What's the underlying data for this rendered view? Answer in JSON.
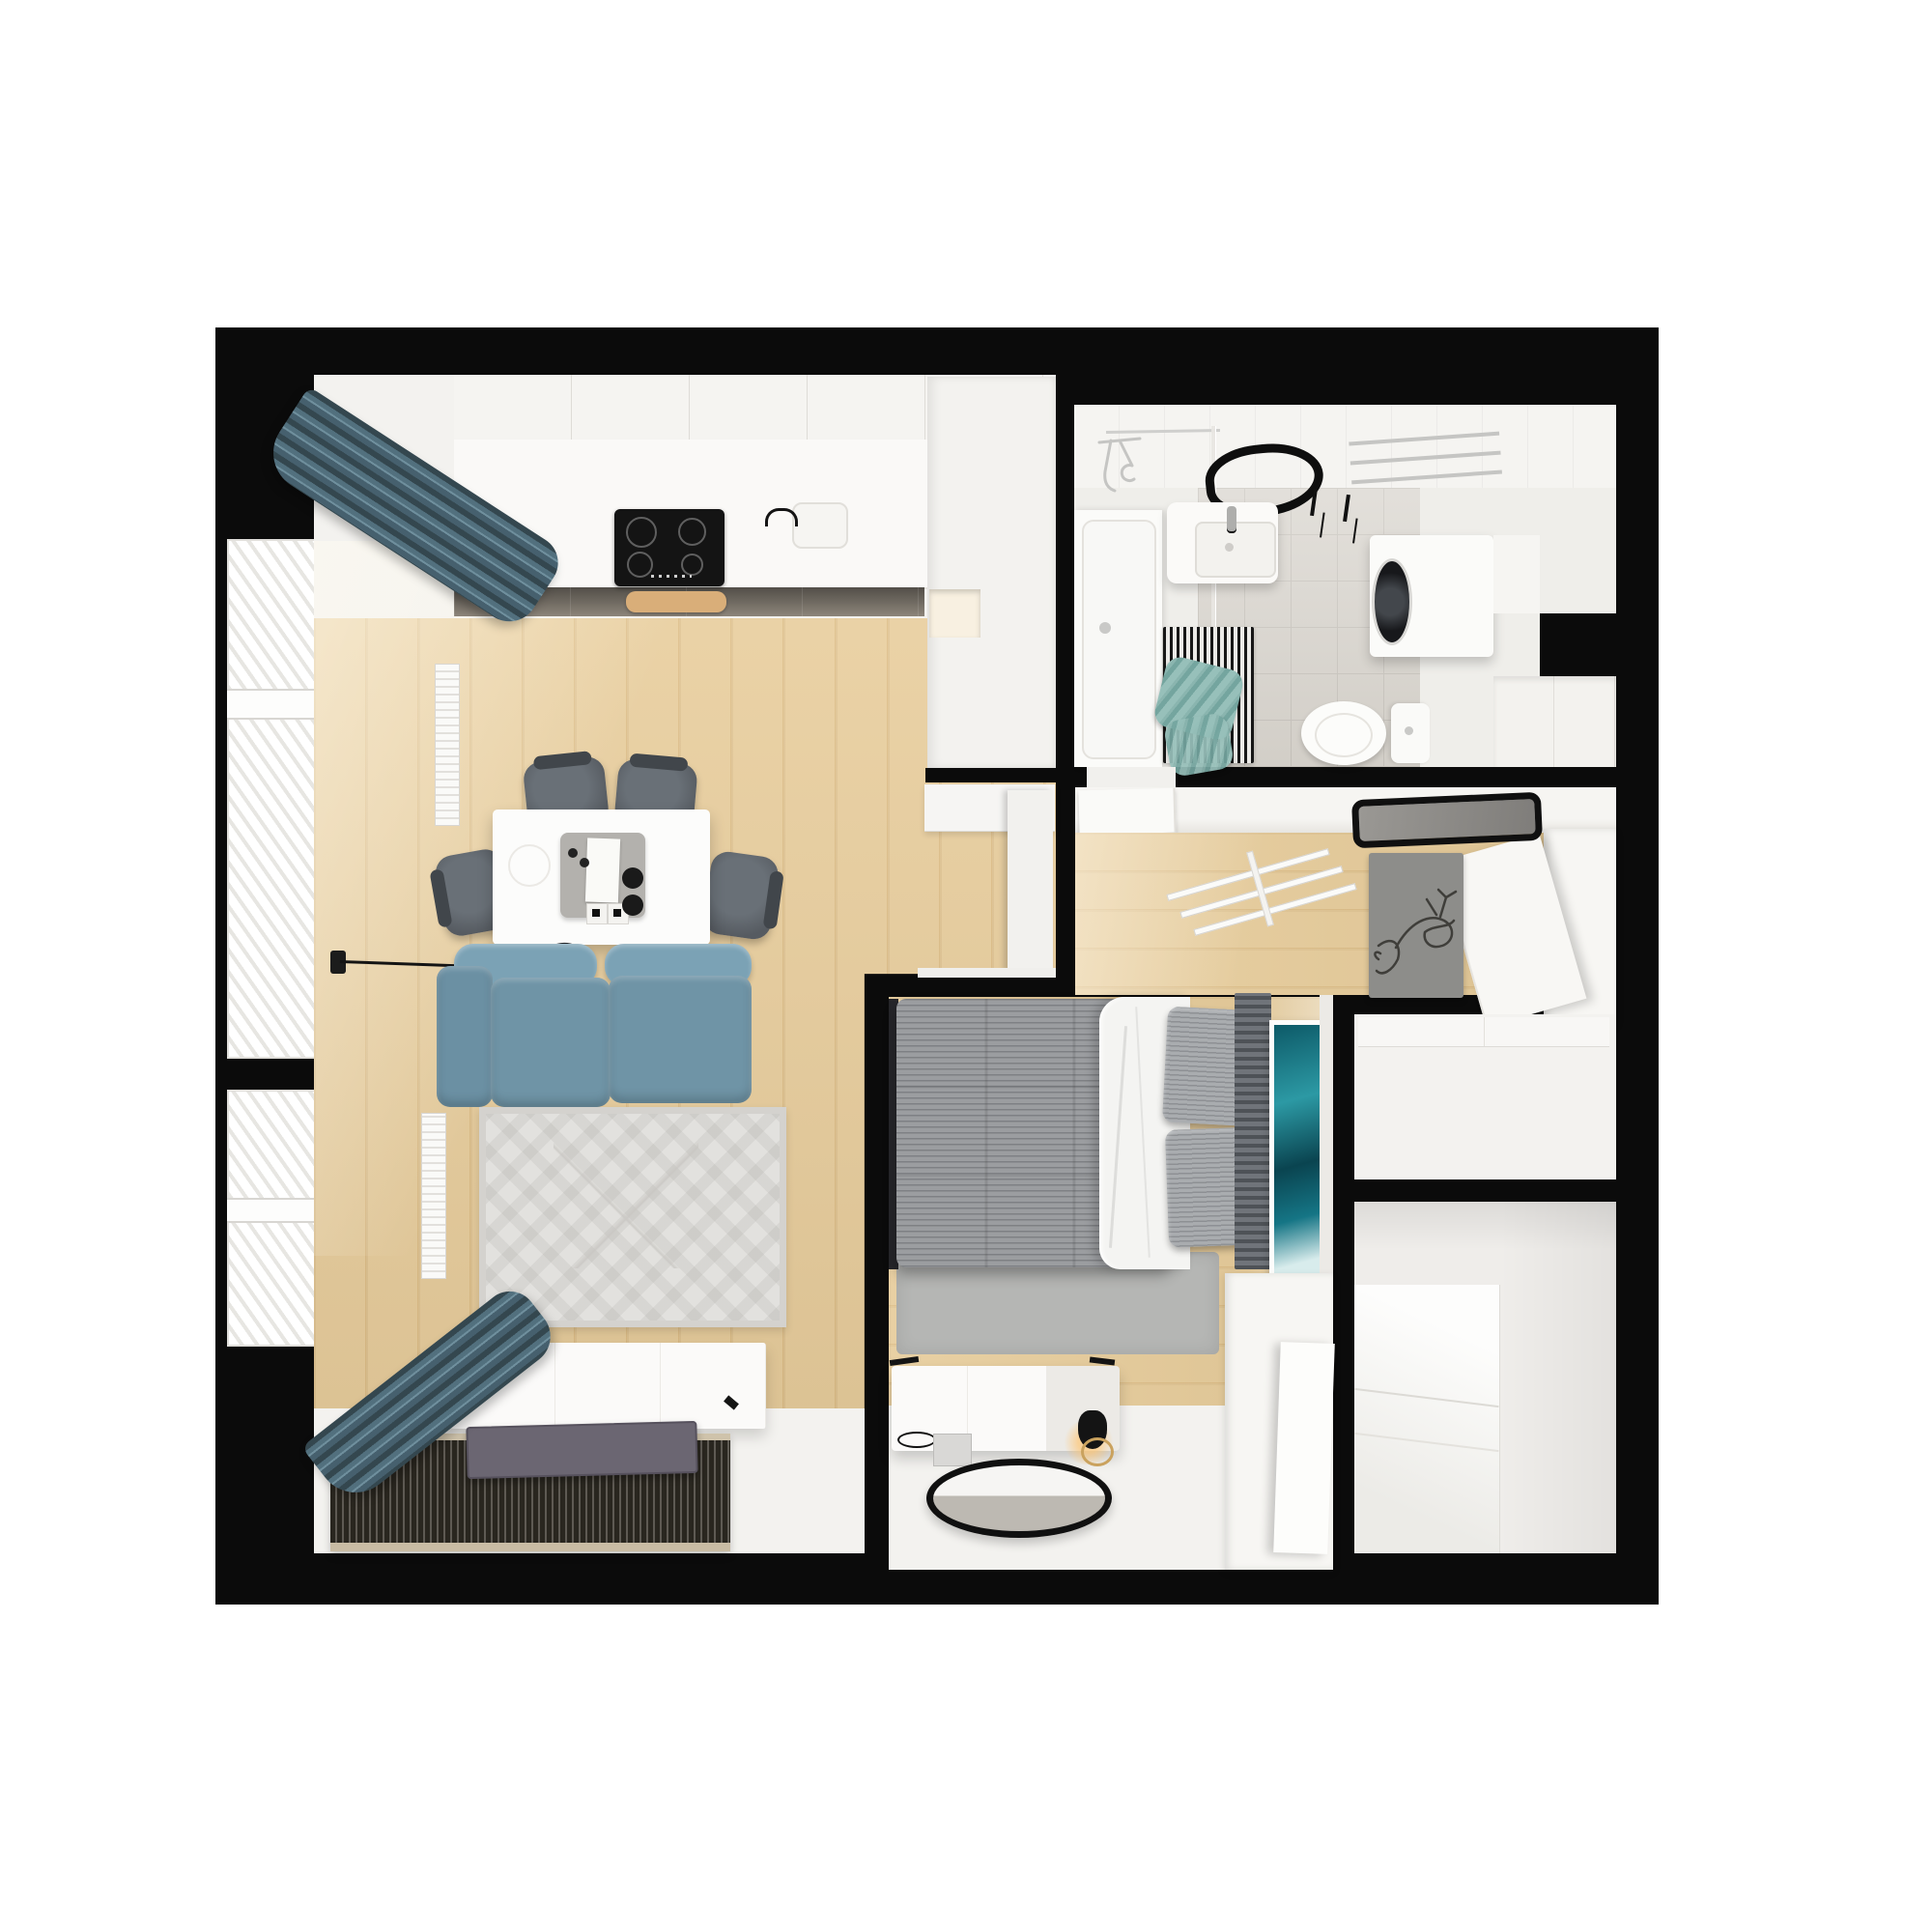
{
  "scene": {
    "title": "Small apartment 3D floor plan, top-down render",
    "style": "photoreal dollhouse cutaway on white background",
    "rooms_count": 5
  },
  "palette": {
    "wall": "#0b0b0b",
    "woodLiving": "#e8cd9c",
    "woodHall": "#e6cb99",
    "floorWhite": "#f3f2ef",
    "ceiling": "#f5f4f1",
    "counter": "#faf9f7",
    "baseDark": "#524e48",
    "cooktop": "#141414",
    "island": "#fcfcfb",
    "tray": "#b3b1ad",
    "stool": "#565b61",
    "sofa": "#6f94a6",
    "sofaLight": "#7ba2b5",
    "curtain": "#46606e",
    "rugLiving": "#e2e1de",
    "tvCabinet": "#fbfaf9",
    "slatMat": "#29261f",
    "tvPanel": "#6b6672",
    "radiator": "#f8f8f6",
    "tile": "#d9d5ce",
    "tileLine": "#c9c5be",
    "tub": "#fbfbf9",
    "towel": "#8ab5af",
    "matDark": "#171717",
    "washer": "#fbfbf9",
    "ringLight": "#0e0e0e",
    "duvet": "#9b9da0",
    "blanket": "#f4f4f2",
    "pillow": "#a9acaf",
    "headboard": "#5a5e63",
    "art": "#15707f",
    "carpet": "#b5b6b4",
    "bench": "#fbfaf9",
    "mirrorRim": "#101010",
    "wardrobe": "#f7f6f3",
    "deerRug": "#8d8d8a",
    "deerLine": "#3f3e3a",
    "chrome": "#c5c5c3",
    "glow": "#ffc46e"
  },
  "rooms": {
    "living": {
      "label": "Open living room and kitchen",
      "furniture": [
        "corner windows with blinds",
        "blue-grey curtains",
        "two radiators",
        "white upper kitchen cabinets",
        "kitchen counter with dark base front",
        "black induction cooktop",
        "wooden cutting board",
        "sink with black faucet",
        "pantry column with lit niche",
        "white kitchen island",
        "grey serving tray",
        "condiment jars",
        "pepper mills",
        "four dark bar stools",
        "black wall-mounted arc lamp",
        "blue two-seat sofa with chaise",
        "light diamond-pattern area rug",
        "white TV sideboard",
        "dark slatted floor mat",
        "flat TV panel lying on mat",
        "open white door to hallway",
        "white console by door"
      ]
    },
    "bathroom": {
      "label": "Bathroom",
      "furniture": [
        "bathtub with chrome shower set",
        "glass shower screen",
        "black LED ring light",
        "white vanity washbasin",
        "chrome towel ladder",
        "black wall hooks",
        "washing machine with dark porthole",
        "white counter cabinet",
        "low cabinet",
        "toilet with cistern",
        "black-and-white striped mat",
        "teal striped towels"
      ]
    },
    "hallway": {
      "label": "Hallway",
      "furniture": [
        "wall shelf band",
        "open bathroom door",
        "white leaning clothes rack",
        "black framed mirror",
        "grey rug with deer line art",
        "tall white wardrobe",
        "open wardrobe door",
        "low shoe console"
      ]
    },
    "bedroom": {
      "label": "Bedroom",
      "furniture": [
        "double bed with grey quilted duvet",
        "white throw blanket",
        "two striped pillows",
        "dark slatted headboard panel",
        "teal abstract wall art",
        "fluffy grey carpet",
        "white dresser bench",
        "eyeglasses",
        "magazine",
        "black table lamp with warm glow",
        "round black-rim mirror on floor",
        "white wardrobe with open door"
      ]
    },
    "storage": {
      "label": "Storage / walk-in closet",
      "furniture": [
        "built-in white wardrobe",
        "bright open door panel"
      ]
    }
  }
}
